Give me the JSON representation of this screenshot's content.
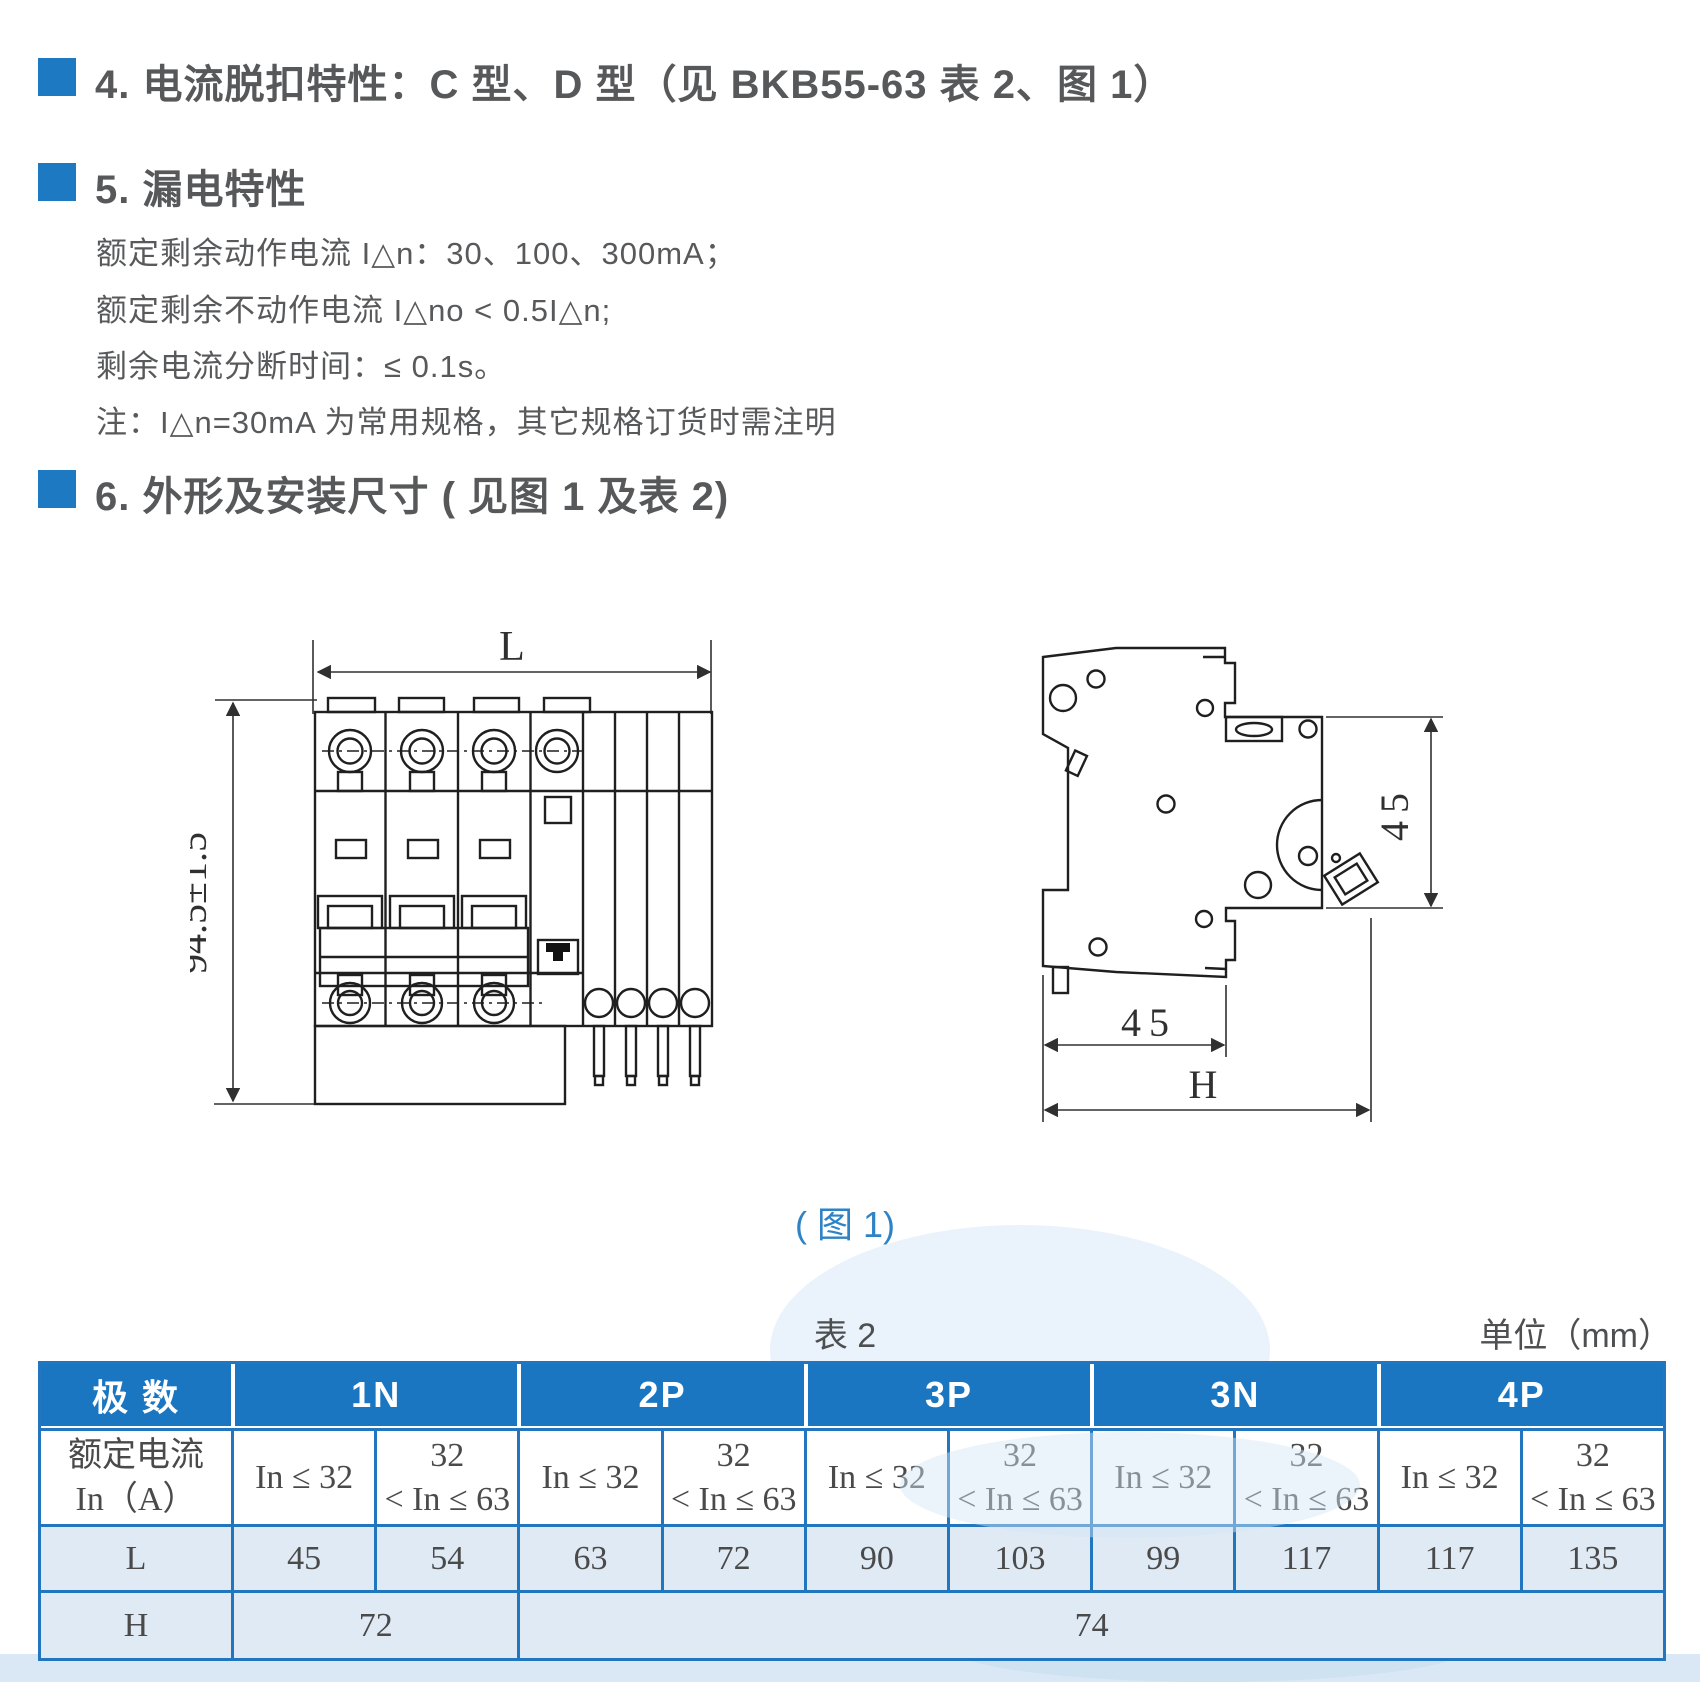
{
  "colors": {
    "accent_blue": "#1d7ac2",
    "table_header_blue": "#1b76c1",
    "table_border_blue": "#2176bf",
    "cell_light_blue": "#dfeaf5",
    "caption_blue": "#2e82c6",
    "heading_text": "#57585a",
    "body_text": "#58595b"
  },
  "sections": {
    "s4": {
      "title": "4. 电流脱扣特性：C 型、D 型（见 BKB55-63 表 2、图 1）"
    },
    "s5": {
      "title": "5. 漏电特性",
      "lines": [
        "额定剩余动作电流 I△n：30、100、300mA；",
        "额定剩余不动作电流 I△no < 0.5I△n;",
        "剩余电流分断时间：≤ 0.1s。",
        "注：I△n=30mA 为常用规格，其它规格订货时需注明"
      ]
    },
    "s6": {
      "title": "6. 外形及安装尺寸 ( 见图 1 及表 2)"
    }
  },
  "figure": {
    "caption": "( 图 1)",
    "front_view": {
      "width_label": "L",
      "height_label": "94.5±1.5"
    },
    "side_view": {
      "front_height_label": "45",
      "depth_label": "45",
      "total_label": "H"
    }
  },
  "table2": {
    "caption": "表 2",
    "unit_note": "单位（mm）",
    "corner_header": "极 数",
    "pole_groups": [
      "1N",
      "2P",
      "3P",
      "3N",
      "4P"
    ],
    "current_row_label": "额定电流\nIn（A）",
    "current_low": "In ≤ 32",
    "current_high": "32\n< In ≤ 63",
    "L_row_label": "L",
    "L_values": [
      "45",
      "54",
      "63",
      "72",
      "90",
      "103",
      "99",
      "117",
      "117",
      "135"
    ],
    "H_row_label": "H",
    "H_value_1N": "72",
    "H_value_rest": "74"
  }
}
